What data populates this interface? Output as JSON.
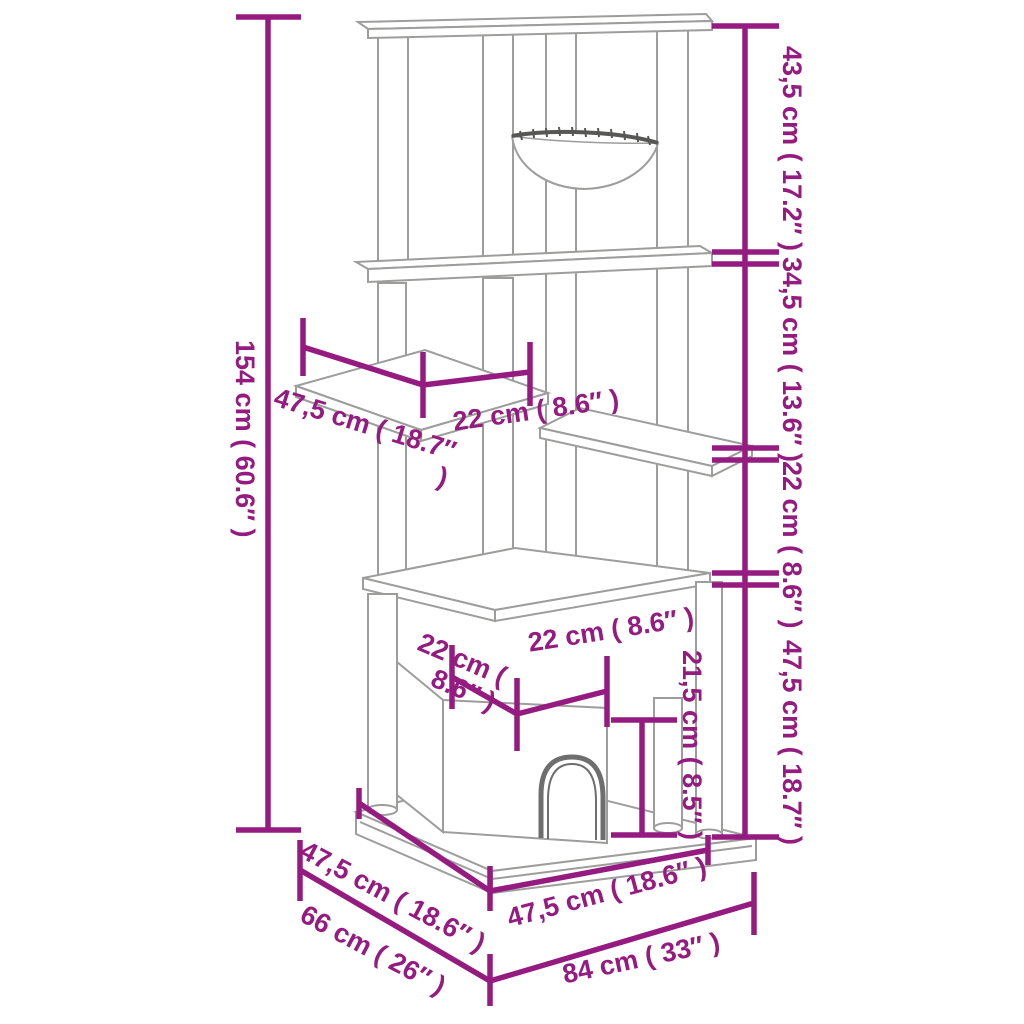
{
  "diagram": {
    "type": "product-dimension-diagram",
    "subject": "cat scratching tree with hammock, shelf, cat house and base",
    "colors": {
      "dimension_accent": "#951B81",
      "drawing_line": "#9D9D9C",
      "drawing_detail_dark": "#575756",
      "door_arch": "#6E6E6E",
      "background": "#FFFFFF"
    },
    "labels": {
      "total_height": "154 cm ( 60.6″ )",
      "seg_top": "43,5 cm ( 17.2″ )",
      "seg_upper_mid": "34,5 cm ( 13.6″ )",
      "seg_lower_mid": "22 cm ( 8.6″ )",
      "seg_bottom": "47,5 cm ( 18.7″ )",
      "shelf_depth": "47,5 cm ( 18.7″ )",
      "shelf_width": "22 cm ( 8.6″ )",
      "house_depth": "22 cm ( 8.6″ )",
      "house_width": "22 cm ( 8.6″ )",
      "door_height": "21,5 cm ( 8.5″ )",
      "base_half_depth": "47,5 cm ( 18.6″ )",
      "base_depth": "66 cm ( 26″ )",
      "base_half_width": "47,5 cm ( 18.6″ )",
      "base_width": "84 cm ( 33″ )"
    }
  }
}
